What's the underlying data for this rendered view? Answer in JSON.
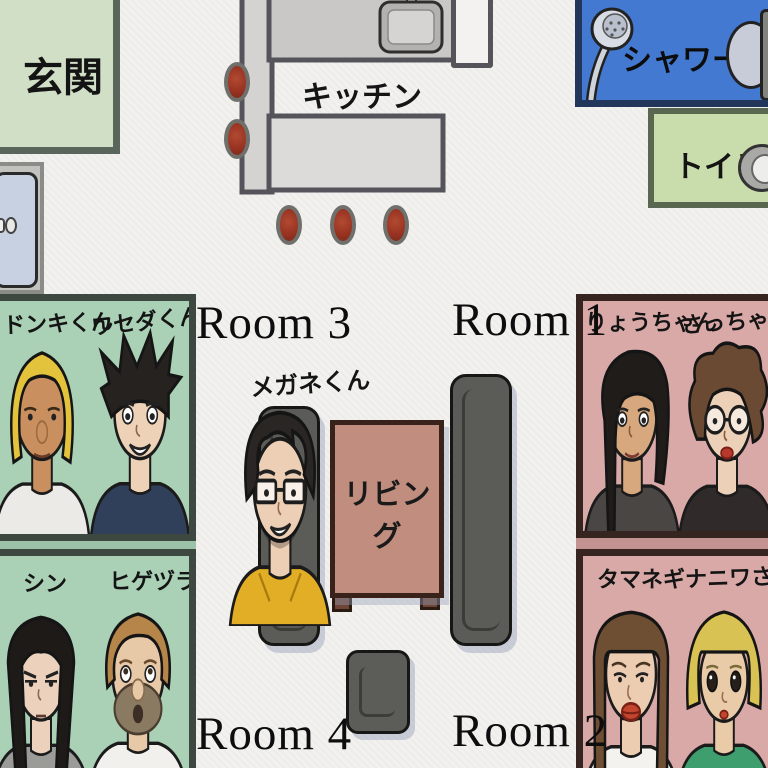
{
  "areas": {
    "genkan": {
      "label": "玄関"
    },
    "kitchen": {
      "label": "キッチン"
    },
    "shower": {
      "label": "シャワー"
    },
    "toilet": {
      "label": "トイレ"
    },
    "living": {
      "label": "リビング"
    }
  },
  "living_resident": {
    "name": "メガネくん"
  },
  "rooms": [
    {
      "label": "Room 1",
      "members": [
        {
          "name": "りょうちゃん"
        },
        {
          "name": "さっちゃん"
        }
      ]
    },
    {
      "label": "Room 2",
      "members": [
        {
          "name": "タマネギ"
        },
        {
          "name": "ナニワさん"
        }
      ]
    },
    {
      "label": "Room 3",
      "members": [
        {
          "name": "ドンキくん"
        },
        {
          "name": "ワセダくん"
        }
      ]
    },
    {
      "label": "Room 4",
      "members": [
        {
          "name": "シン"
        },
        {
          "name": "ヒゲヅラ"
        }
      ]
    }
  ],
  "portraits": {
    "donki": {
      "hair": "#e3c33c",
      "skin": "#c98f5f",
      "shirt": "#eceae6"
    },
    "waseda": {
      "hair": "#26221f",
      "skin": "#eed2b8",
      "shirt": "#31405a"
    },
    "shin": {
      "hair": "#1d1a18",
      "skin": "#ecd2bc",
      "shirt": "#9b9b97"
    },
    "higezura": {
      "hair": "#b5854a",
      "skin": "#e7c9a8",
      "shirt": "#f2f0ec",
      "beard": "#8a7a62"
    },
    "megane": {
      "hair": "#2a2624",
      "skin": "#eccfb4",
      "shirt": "#e2ae25"
    },
    "ryo": {
      "hair": "#201c1a",
      "skin": "#d7a87e",
      "shirt": "#4a4644"
    },
    "sacchan": {
      "hair": "#6b4a33",
      "skin": "#ecd0b8",
      "shirt": "#302b2a"
    },
    "tamanegi": {
      "hair": "#6e4f33",
      "skin": "#eccdb2",
      "shirt": "#f4f2ee"
    },
    "naniwa": {
      "hair": "#d8c254",
      "skin": "#e9cba8",
      "shirt": "#3f9e6e"
    }
  },
  "colors": {
    "background": "#f2f1ee",
    "room_green_fill": "#aad0b6",
    "room_green_border": "#3c4840",
    "room_pink_fill": "#d9a9a7",
    "room_pink_border": "#362420",
    "genkan_fill": "#d0dfc6",
    "shower_fill": "#4479d2",
    "toilet_fill": "#c9dcab",
    "counter_gray": "#c9c8c6",
    "stool_red": "#9a3422",
    "table_brown": "#c08d7e",
    "sofa_gray": "#5b5b57"
  }
}
